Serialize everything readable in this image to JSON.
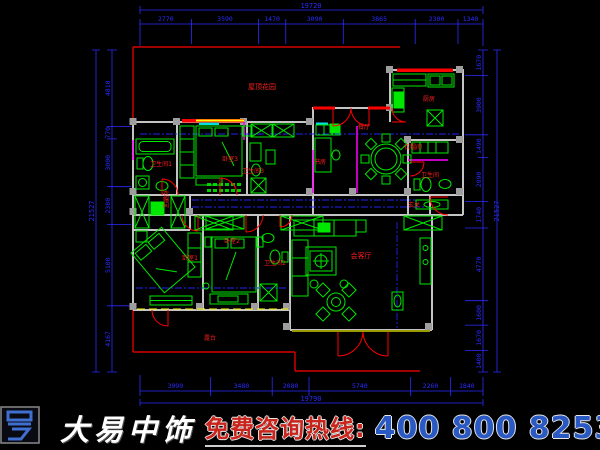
{
  "colors": {
    "background": "#000000",
    "dimension_blue": "#2b2bff",
    "wall_gray": "#c4c4c4",
    "furniture_green": "#00e800",
    "outline_red": "#ff0000",
    "accent_magenta": "#ff00ff",
    "accent_yellow": "#ffff00",
    "accent_cyan": "#00e0e0",
    "phone_blue": "#2b59c3",
    "hotline_red": "#c9251d"
  },
  "dimensions": {
    "top": {
      "total": "19720",
      "segments": [
        "2770",
        "3590",
        "1470",
        "3090",
        "3865",
        "2300",
        "1340"
      ]
    },
    "bottom": {
      "total": "19790",
      "segments": [
        "3990",
        "3480",
        "2080",
        "5740",
        "2260",
        "1840"
      ]
    },
    "left": {
      "total": "21527",
      "segments": [
        "4810",
        "770",
        "3000",
        "2380",
        "5100",
        "4167"
      ]
    },
    "right": {
      "total": "21527",
      "segments": [
        "1670",
        "3900",
        "1490",
        "2890",
        "1740",
        "4770",
        "1600",
        "1670",
        "1400"
      ]
    }
  },
  "rooms": {
    "roof_garden": "屋顶花园",
    "kitchen": "厨房",
    "dining": "餐厅",
    "study": "书房",
    "cloak_right": "衣帽间",
    "bath_right": "卫生间",
    "bedroom3": "卧室3",
    "bath3": "卫生间3",
    "bath1": "卫生间1",
    "entry": "玄关",
    "living": "会客厅",
    "bedroom1": "卧室1",
    "bedroom2": "卧室2",
    "bath2": "卫生间2",
    "cloak_left": "衣帽间",
    "terrace": "露台"
  },
  "footer": {
    "brand": "大易中饰",
    "hotline": "免费咨询热线:",
    "phone": "400 800 8253"
  }
}
